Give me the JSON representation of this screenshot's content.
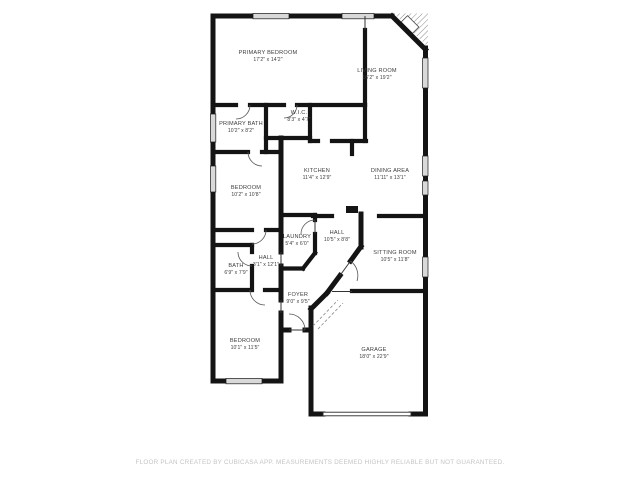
{
  "title": "Floor plan",
  "colors": {
    "wall": "#141414",
    "window_fill": "#d9d9d9",
    "label_text": "#3d3d3d",
    "footer_text": "#c4c4c4",
    "background": "#ffffff"
  },
  "rooms": [
    {
      "name": "PRIMARY BEDROOM",
      "dims": "17'2\" x 14'2\""
    },
    {
      "name": "LIVING ROOM",
      "dims": "16'2\" x 19'2\""
    },
    {
      "name": "PRIMARY BATH",
      "dims": "10'2\" x 8'2\""
    },
    {
      "name": "W.I.C.",
      "dims": "8'3\" x 4'7\""
    },
    {
      "name": "KITCHEN",
      "dims": "11'4\" x 12'9\""
    },
    {
      "name": "DINING AREA",
      "dims": "11'11\" x 13'1\""
    },
    {
      "name": "BEDROOM",
      "dims": "10'2\" x 10'8\""
    },
    {
      "name": "LAUNDRY",
      "dims": "5'4\" x 6'0\""
    },
    {
      "name": "HALL",
      "dims": "10'5\" x 8'8\""
    },
    {
      "name": "SITTING ROOM",
      "dims": "10'5\" x 11'8\""
    },
    {
      "name": "BATH",
      "dims": "6'9\" x 7'9\""
    },
    {
      "name": "HALL",
      "dims": "3'1\" x 12'1\""
    },
    {
      "name": "FOYER",
      "dims": "9'0\" x 9'5\""
    },
    {
      "name": "BEDROOM",
      "dims": "10'1\" x 11'5\""
    },
    {
      "name": "GARAGE",
      "dims": "18'0\" x 22'9\""
    }
  ],
  "footer": {
    "disclaimer": "FLOOR PLAN CREATED BY CUBICASA APP. MEASUREMENTS DEEMED HIGHLY RELIABLE BUT NOT GUARANTEED."
  }
}
